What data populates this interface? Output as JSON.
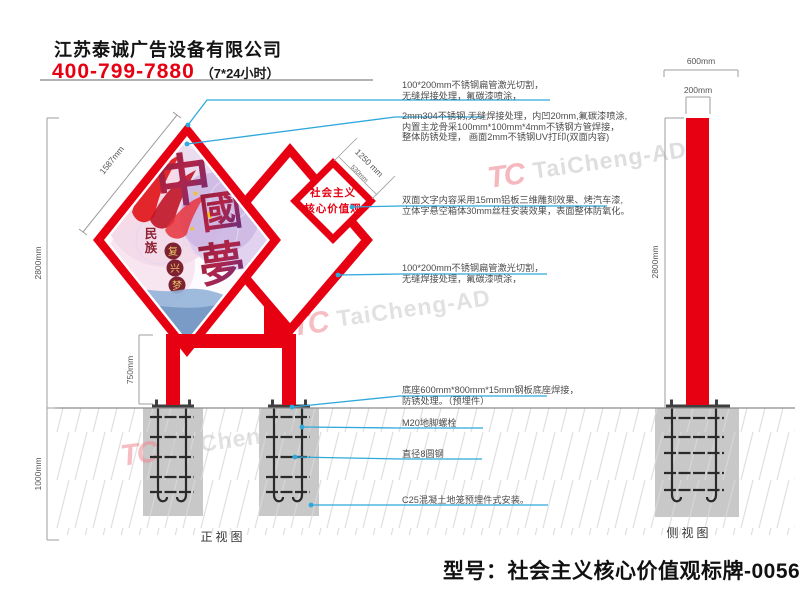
{
  "header": {
    "company": "江苏泰诚广告设备有限公司",
    "phone": "400-799-7880",
    "hours": "（7*24小时）"
  },
  "annotations": {
    "a1_line1": "100*200mm不锈钢扁管激光切割，",
    "a1_line2": "无缝焊接处理，氟碳漆喷涂，",
    "a2_line1": "2mm304不锈钢,无缝焊接处理，内凹20mm,氟碳漆喷涂,",
    "a2_line2": "内置主龙骨采100mm*100mm*4mm不锈钢方管焊接，",
    "a2_line3": "整体防锈处理， 画面2mm不锈钢UV打印(双面内容)",
    "a3_line1": "双面文字内容采用15mm铝板三维雕刻效果、烤汽车漆,",
    "a3_line2": "立体字悬空箱体30mm丝柱安装效果，表面整体防氧化。",
    "a4_line1": "100*200mm不锈钢扁管激光切割，",
    "a4_line2": "无缝焊接处理，氟碳漆喷涂，",
    "a5_line1": "底座600mm*800mm*15mm钢板底座焊接，",
    "a5_line2": "防锈处理。（预埋件）",
    "a6": "M20地脚螺栓",
    "a7": "直径8圆钢",
    "a8": "C25混凝土地笼预埋件式安装。"
  },
  "dimensions": {
    "panel_edge": "1587mm",
    "height_above": "2800mm",
    "underground": "1000mm",
    "leg": "750mm",
    "small_edge": "1250 mm",
    "small_edge2": "530mm",
    "base_width": "600mm",
    "pole_width": "200mm",
    "side_height": "2800mm"
  },
  "views": {
    "front": "正视图",
    "side": "侧视图"
  },
  "footer": {
    "model": "型号：社会主义核心价值观标牌-0056"
  },
  "sign": {
    "small_line1": "社会主义",
    "small_line2": "核心价值观",
    "art_char1": "中",
    "art_char2": "國",
    "art_char3": "夢",
    "vert_char1": "民",
    "vert_char2": "族",
    "circle1": "复",
    "circle2": "兴",
    "circle3": "梦",
    "star": "★"
  },
  "watermark": {
    "logo": "TC",
    "text": "TaiCheng-AD"
  },
  "colors": {
    "red": "#e60012",
    "leader": "#2fa8dc",
    "concrete": "#c8c8c8"
  }
}
